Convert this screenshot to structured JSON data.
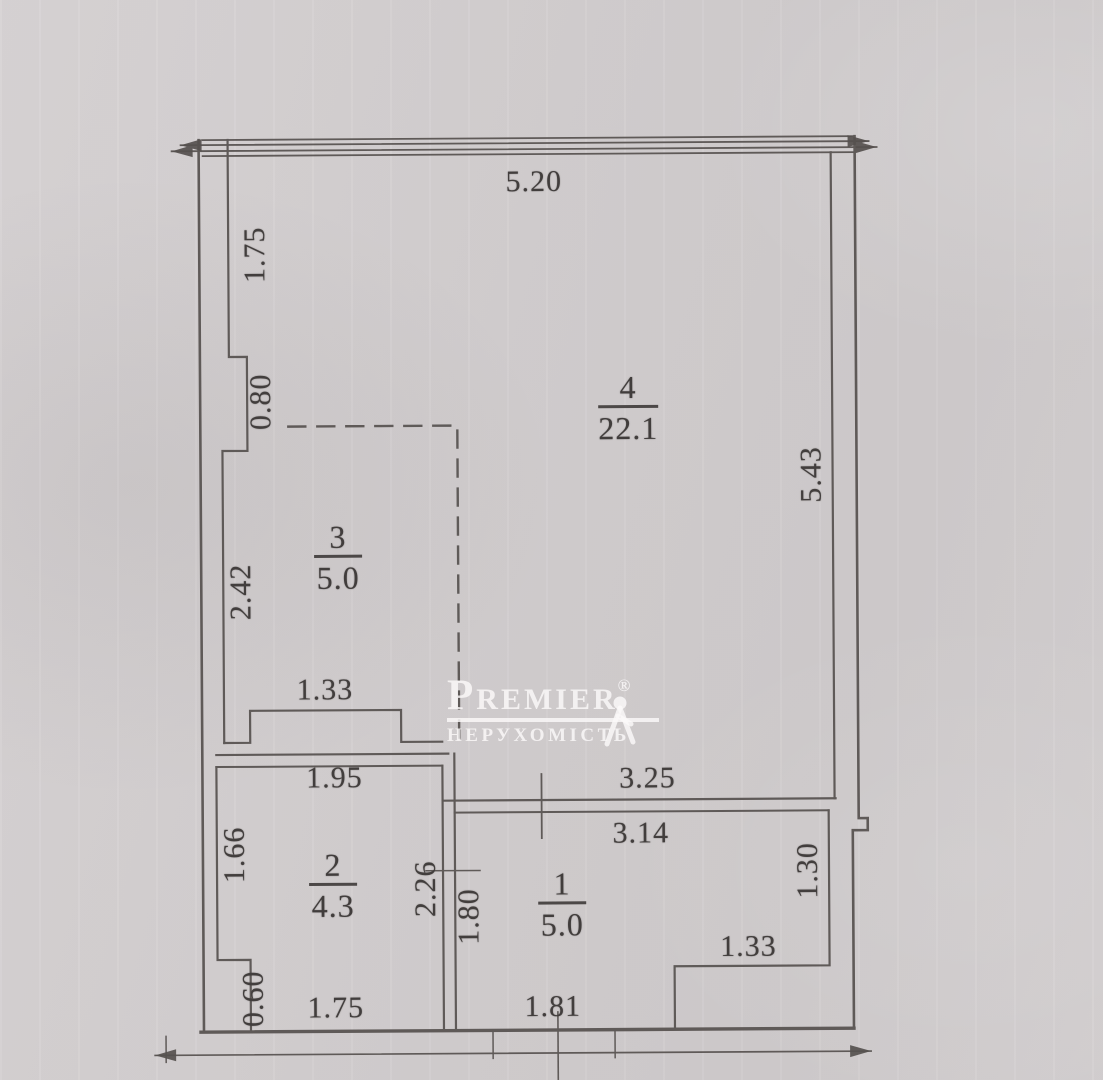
{
  "watermark": {
    "brand": "Premier",
    "registered": "®",
    "subtitle": "НЕРУХОМІСТЬ"
  },
  "plan": {
    "type": "apartment floor plan, scanned",
    "rooms": [
      {
        "number": "4",
        "area": "22.1",
        "x": 629,
        "rule_y": 407
      },
      {
        "number": "3",
        "area": "5.0",
        "x": 338,
        "rule_y": 555
      },
      {
        "number": "2",
        "area": "4.3",
        "x": 331,
        "rule_y": 883
      },
      {
        "number": "1",
        "area": "5.0",
        "x": 560,
        "rule_y": 903
      }
    ],
    "dimensions": [
      {
        "text": "5.20",
        "x": 536,
        "y": 182,
        "rot": 0
      },
      {
        "text": "1.75",
        "x": 257,
        "y": 253,
        "rot": -90
      },
      {
        "text": "0.80",
        "x": 262,
        "y": 400,
        "rot": -90
      },
      {
        "text": "2.42",
        "x": 241,
        "y": 590,
        "rot": -90
      },
      {
        "text": "1.33",
        "x": 324,
        "y": 689,
        "rot": 0
      },
      {
        "text": "1.95",
        "x": 333,
        "y": 777,
        "rot": 0
      },
      {
        "text": "1.66",
        "x": 233,
        "y": 853,
        "rot": -90
      },
      {
        "text": "2.26",
        "x": 424,
        "y": 888,
        "rot": -90
      },
      {
        "text": "1.80",
        "x": 467,
        "y": 916,
        "rot": -90
      },
      {
        "text": "0.60",
        "x": 251,
        "y": 997,
        "rot": -90
      },
      {
        "text": "1.75",
        "x": 333,
        "y": 1007,
        "rot": 0
      },
      {
        "text": "3.25",
        "x": 646,
        "y": 779,
        "rot": 0
      },
      {
        "text": "3.14",
        "x": 639,
        "y": 834,
        "rot": 0
      },
      {
        "text": "5.43",
        "x": 812,
        "y": 476,
        "rot": -90
      },
      {
        "text": "1.30",
        "x": 806,
        "y": 872,
        "rot": -90
      },
      {
        "text": "1.33",
        "x": 746,
        "y": 948,
        "rot": 0
      },
      {
        "text": "1.81",
        "x": 550,
        "y": 1007,
        "rot": 0
      }
    ]
  }
}
